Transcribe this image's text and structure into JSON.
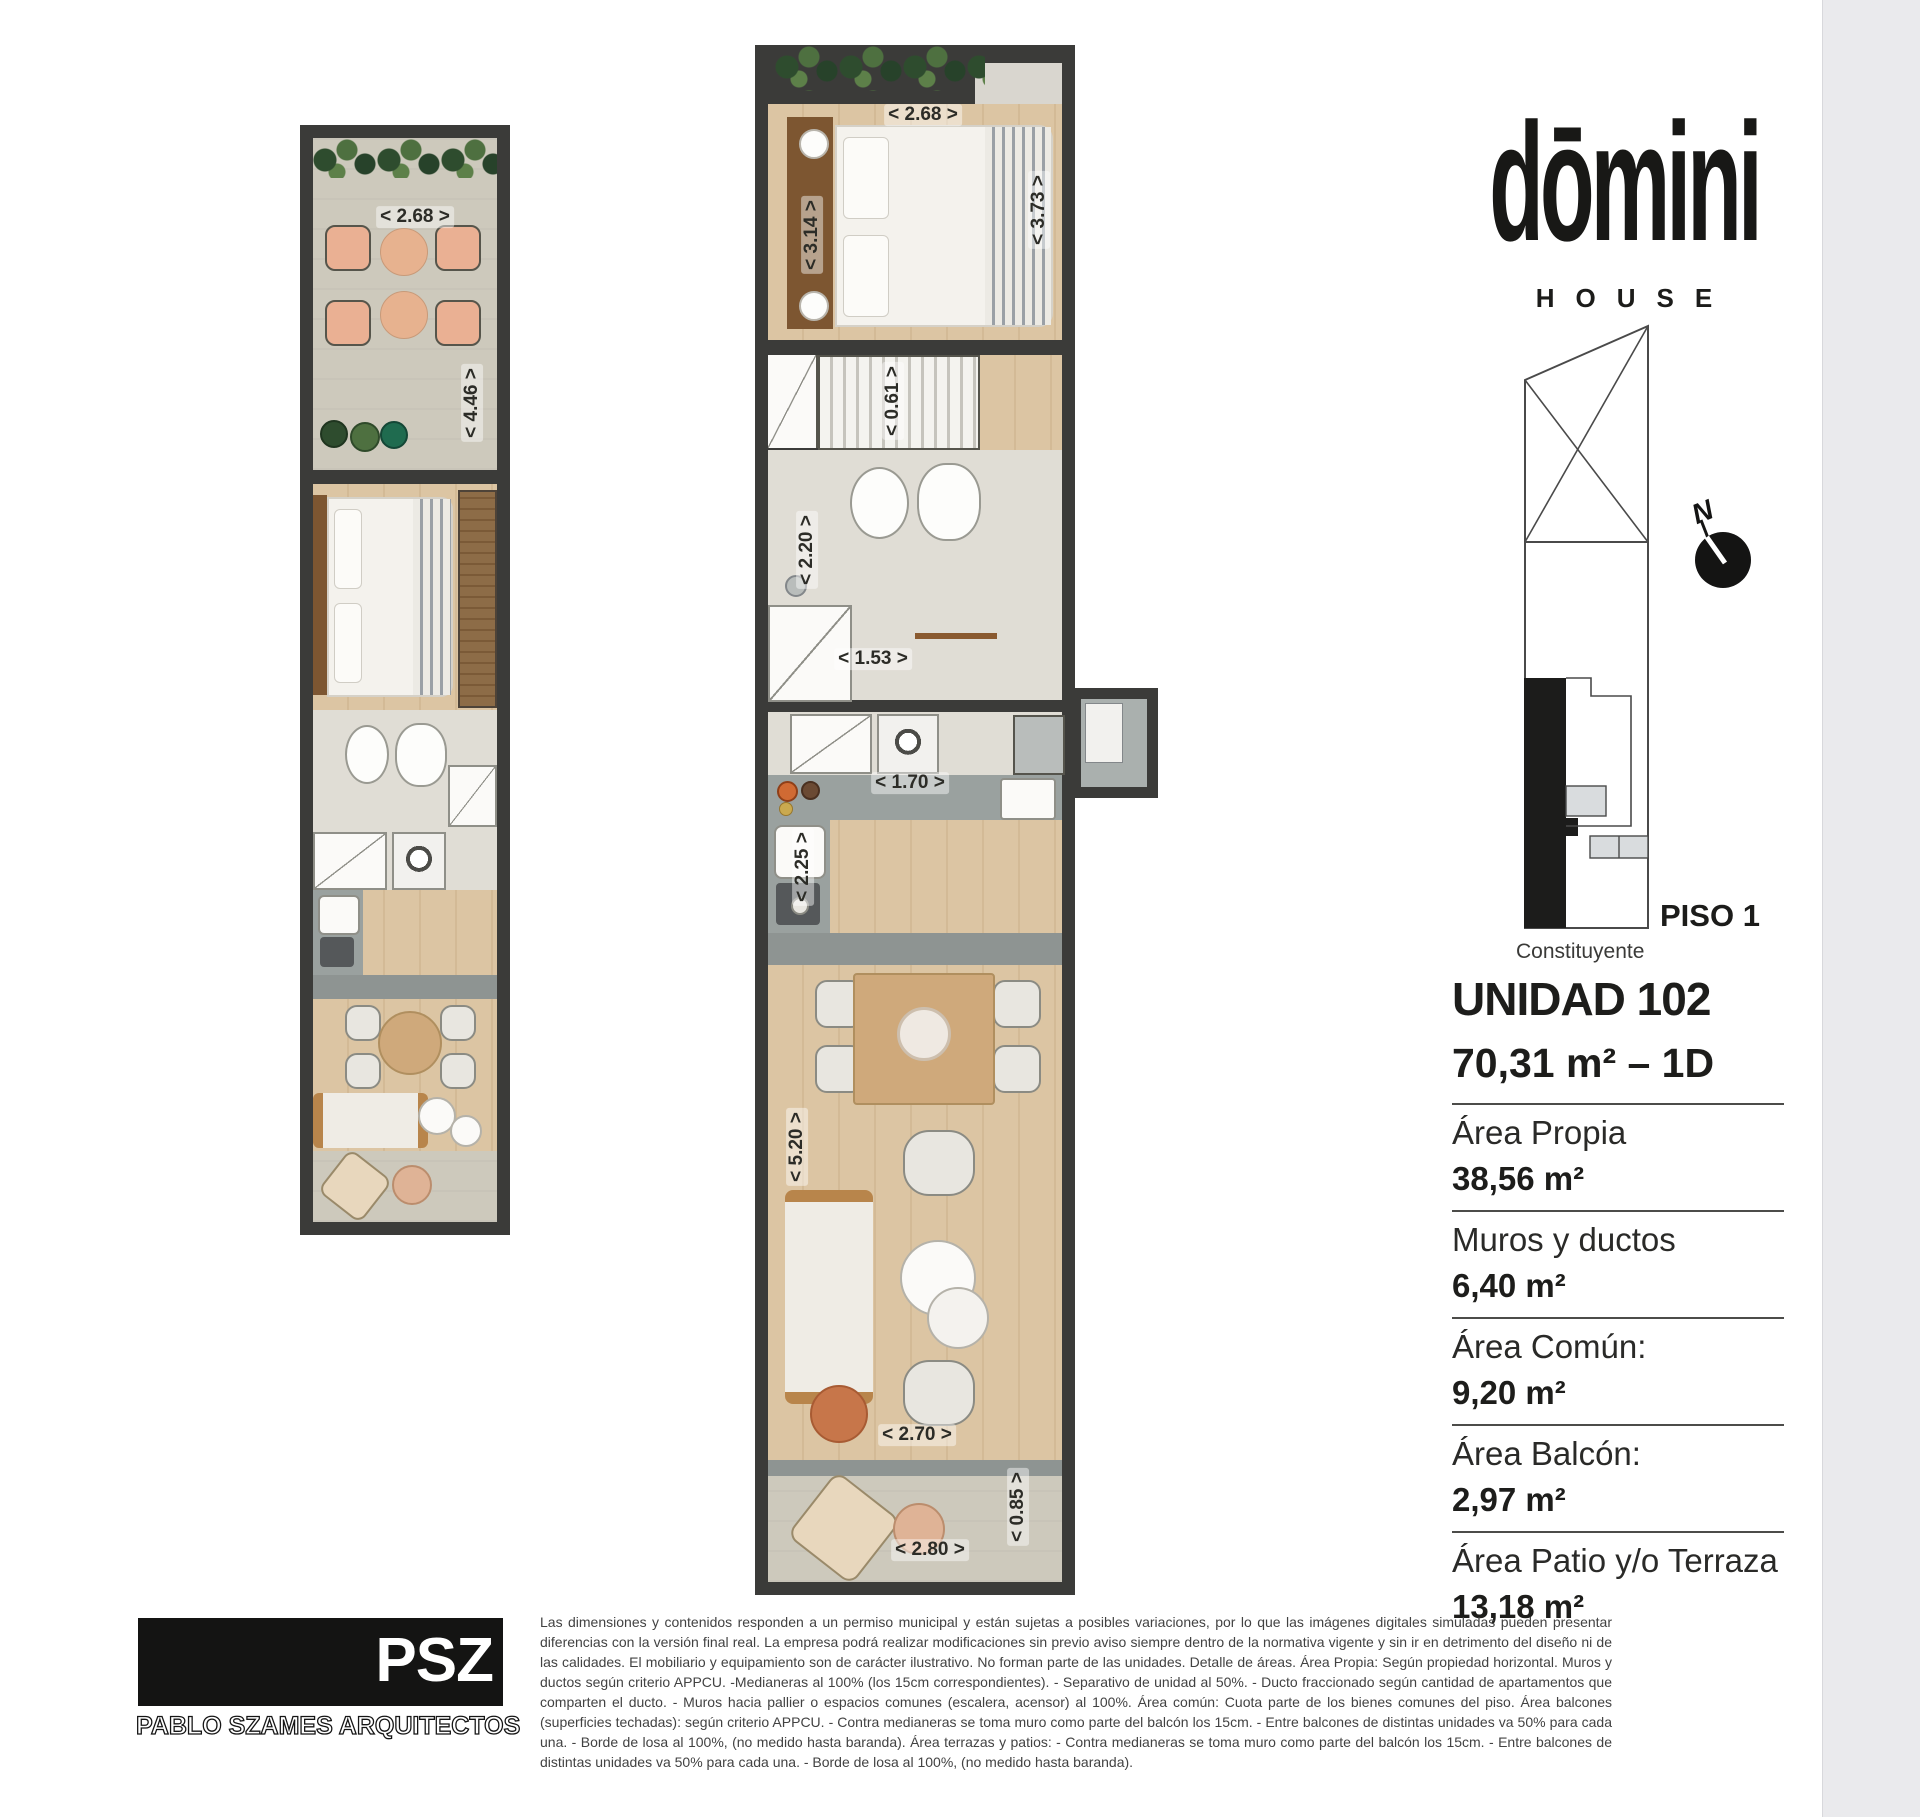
{
  "brand": {
    "logo": "dōmini",
    "sub": "HOUSE"
  },
  "location": {
    "floor_label": "PISO 1",
    "street_label": "Constituyente",
    "north_label": "N"
  },
  "unit": {
    "title": "UNIDAD 102",
    "subtitle": "70,31 m² – 1D",
    "areas": [
      {
        "label": "Área Propia",
        "value": "38,56 m²"
      },
      {
        "label": "Muros y ductos",
        "value": "6,40 m²"
      },
      {
        "label": "Área Común:",
        "value": "9,20 m²"
      },
      {
        "label": "Área Balcón:",
        "value": "2,97 m²"
      },
      {
        "label": "Área Patio y/o Terraza",
        "value": "13,18 m²"
      }
    ]
  },
  "plans": {
    "left": {
      "dims": {
        "terrace_w": "< 2.68 >",
        "terrace_h": "< 4.46 >"
      }
    },
    "center": {
      "dims": {
        "bedroom_w": "< 2.68 >",
        "bedroom_h": "< 3.14 >",
        "bedroom_side": "< 3.73 >",
        "closet": "< 0.61 >",
        "bath_h": "< 2.20 >",
        "bath_w": "< 1.53 >",
        "kitchen_w": "< 1.70 >",
        "kitchen_h": "< 2.25 >",
        "living_h": "< 5.20 >",
        "living_w": "< 2.70 >",
        "patio_w": "< 2.80 >",
        "patio_h": "< 0.85 >"
      }
    }
  },
  "architect": {
    "logo": "PSZ",
    "name": "PABLO SZAMES ARQUITECTOS"
  },
  "disclaimer": "Las dimensiones y contenidos responden a un permiso municipal y están sujetas a posibles variaciones, por lo que las imágenes digitales simuladas pueden presentar diferencias con la versión final real. La empresa podrá realizar modificaciones sin previo aviso siempre dentro de la normativa vigente y sin ir en detrimento del diseño ni de las calidades. El mobiliario y equipamiento son de carácter ilustrativo. No forman parte de las unidades. Detalle de áreas. Área Propia: Según propiedad horizontal. Muros y ductos según criterio APPCU. -Medianeras al 100% (los 15cm correspondientes). - Separativo de unidad al 50%. - Ducto fraccionado según cantidad de apartamentos que comparten el ducto. - Muros hacia pallier o espacios comunes (escalera, acensor) al 100%. Área común: Cuota parte de los bienes comunes del piso. Área balcones (superficies techadas): según criterio APPCU. - Contra medianeras se toma muro como parte del balcón los 15cm. - Entre balcones de distintas unidades va 50% para cada una. - Borde de losa al 100%, (no medido hasta baranda). Área terrazas y patios: - Contra medianeras se toma muro como parte del balcón los 15cm. - Entre balcones de distintas unidades va 50% para cada una. - Borde de losa al 100%, (no medido hasta baranda).",
  "colors": {
    "wall": "#3b3b39",
    "wood_floor": "#dcc5a3",
    "terrace_floor": "#cdc9bc",
    "counter": "#9aa19f",
    "brand_black": "#141413"
  }
}
